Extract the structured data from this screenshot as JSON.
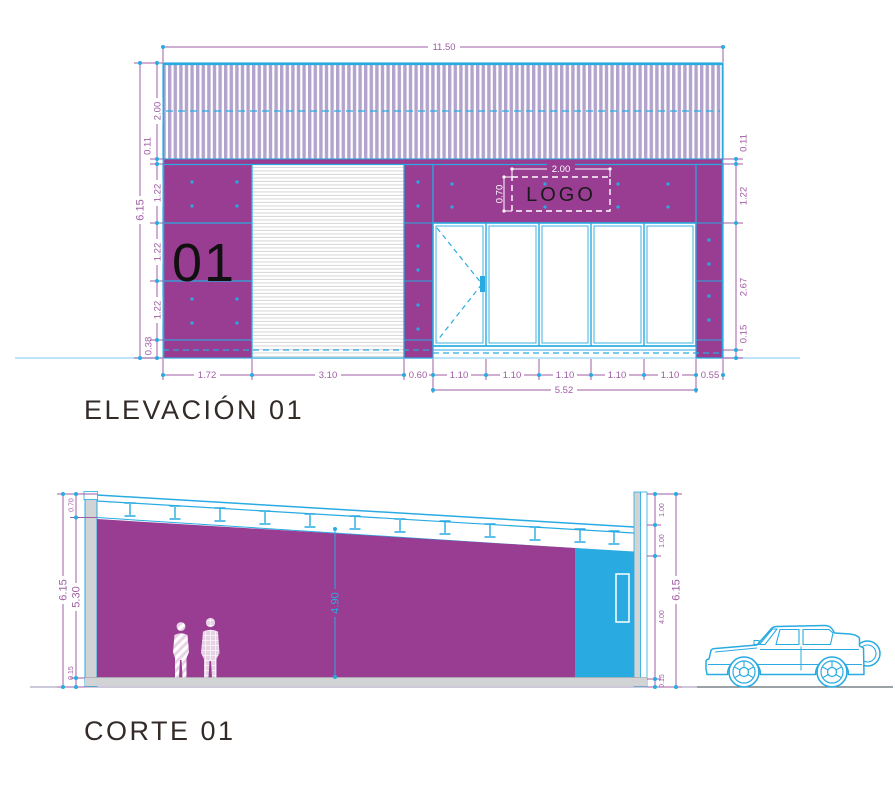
{
  "elevation": {
    "title": "ELEVACIÓN 01",
    "panel_number": "01",
    "logo": {
      "label": "LOGO",
      "width_dim": "2.00",
      "height_dim": "0.70"
    },
    "dims": {
      "total_width": "11.50",
      "total_height": "6.15",
      "roof_band": "2.00",
      "flashing_left": "0.11",
      "rows": [
        "1.22",
        "1.22",
        "1.22"
      ],
      "base": "0.38",
      "flashing_right": "0.11",
      "band_right": "1.22",
      "glass_height": "2.67",
      "sill_right": "0.15",
      "left_panel": "1.72",
      "door": "3.10",
      "pier": "0.60",
      "bays": [
        "1.10",
        "1.10",
        "1.10",
        "1.10",
        "1.10"
      ],
      "right_column": "0.55",
      "storefront": "5.52"
    }
  },
  "section": {
    "title": "CORTE 01",
    "dims": {
      "total_left": "6.15",
      "interior_height": "5.30",
      "roof_edge": "0.70",
      "slab_left": "0.15",
      "clear_height": "4.90",
      "right_top": "1.00",
      "right_mid": "1.00",
      "right_lower": "4.00",
      "slab_right": "0.15",
      "total_right": "6.15"
    }
  },
  "colors": {
    "magenta": "#993D93",
    "cyan": "#29ABE2",
    "dimension": "#A05CA5",
    "hatch_violet": "#B2A4CD",
    "title_text": "#332B28"
  }
}
